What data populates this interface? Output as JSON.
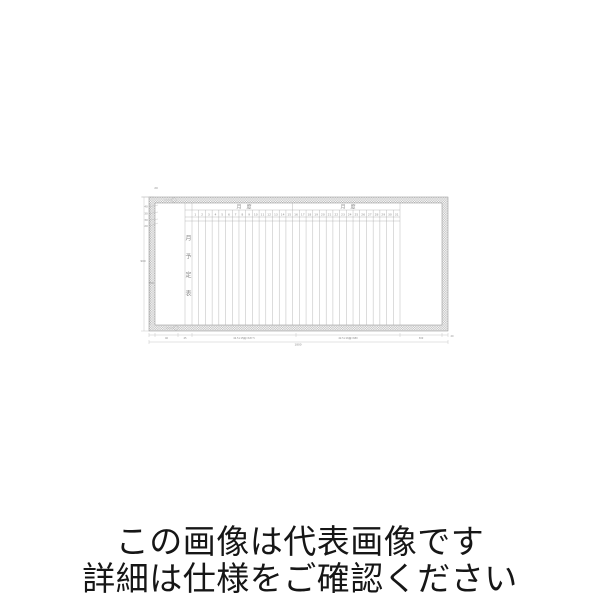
{
  "caption": {
    "line1": "この画像は代表画像です",
    "line2": "詳細は仕様をご確認ください"
  },
  "drawing": {
    "vertical_title": "月予定表",
    "month_header_left": "月　度",
    "month_header_right": "月　度",
    "days": [
      "1",
      "2",
      "3",
      "4",
      "5",
      "6",
      "7",
      "8",
      "9",
      "10",
      "11",
      "12",
      "13",
      "14",
      "15",
      "16",
      "17",
      "18",
      "19",
      "20",
      "21",
      "22",
      "23",
      "24",
      "25",
      "26",
      "27",
      "28",
      "29",
      "30",
      "31"
    ],
    "dims": {
      "top_corner": "20",
      "top_left": [
        "40",
        "30",
        "30",
        "20"
      ],
      "left_total": "900",
      "left_inner": "750",
      "bottom_segments": [
        "40",
        "45",
        "42.5×15隔=637.5",
        "42.5×16隔=680",
        "300",
        "20"
      ],
      "bottom_total": "1800"
    }
  }
}
